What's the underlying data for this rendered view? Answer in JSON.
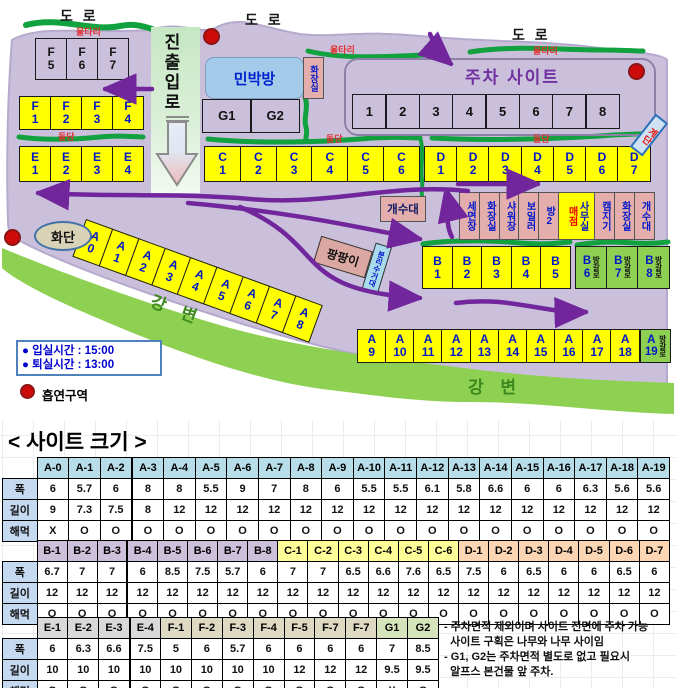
{
  "map": {
    "roads": [
      "도 로",
      "도 로",
      "도 로"
    ],
    "fence_labels": [
      "울타리",
      "울타리",
      "울타리"
    ],
    "wall_labels": [
      "돌담",
      "돌담",
      "돌담"
    ],
    "entrance": "진출입로",
    "minbak": "민박방",
    "toilet_vert": "화장실",
    "parking_title": "주차 사이트",
    "stairs": "계단",
    "sink": "개수대",
    "pang": "팡팡이",
    "recycle": "분리수거대",
    "flower": "화단",
    "bungalow_label": "방갈로",
    "river_labels": [
      "강 변",
      "강 변"
    ],
    "sites": {
      "f_top": [
        [
          "F",
          "5"
        ],
        [
          "F",
          "6"
        ],
        [
          "F",
          "7"
        ]
      ],
      "f": [
        [
          "F",
          "1"
        ],
        [
          "F",
          "2"
        ],
        [
          "F",
          "3"
        ],
        [
          "F",
          "4"
        ]
      ],
      "e": [
        [
          "E",
          "1"
        ],
        [
          "E",
          "2"
        ],
        [
          "E",
          "3"
        ],
        [
          "E",
          "4"
        ]
      ],
      "c": [
        [
          "C",
          "1"
        ],
        [
          "C",
          "2"
        ],
        [
          "C",
          "3"
        ],
        [
          "C",
          "4"
        ],
        [
          "C",
          "5"
        ],
        [
          "C",
          "6"
        ]
      ],
      "d": [
        [
          "D",
          "1"
        ],
        [
          "D",
          "2"
        ],
        [
          "D",
          "3"
        ],
        [
          "D",
          "4"
        ],
        [
          "D",
          "5"
        ],
        [
          "D",
          "6"
        ],
        [
          "D",
          "7"
        ]
      ],
      "parking": [
        [
          "1"
        ],
        [
          "2"
        ],
        [
          "3"
        ],
        [
          "4"
        ],
        [
          "5"
        ],
        [
          "6"
        ],
        [
          "7"
        ],
        [
          "8"
        ]
      ],
      "g": [
        [
          "G1"
        ],
        [
          "G2"
        ]
      ],
      "b": [
        [
          "B",
          "1"
        ],
        [
          "B",
          "2"
        ],
        [
          "B",
          "3"
        ],
        [
          "B",
          "4"
        ],
        [
          "B",
          "5"
        ]
      ],
      "b_bungalow": [
        [
          "B",
          "6"
        ],
        [
          "B",
          "7"
        ],
        [
          "B",
          "8"
        ]
      ],
      "a_diag": [
        [
          "A",
          "0"
        ],
        [
          "A",
          "1"
        ],
        [
          "A",
          "2"
        ],
        [
          "A",
          "3"
        ],
        [
          "A",
          "4"
        ],
        [
          "A",
          "5"
        ],
        [
          "A",
          "6"
        ],
        [
          "A",
          "7"
        ],
        [
          "A",
          "8"
        ]
      ],
      "a_row": [
        [
          "A",
          "9"
        ],
        [
          "A",
          "10"
        ],
        [
          "A",
          "11"
        ],
        [
          "A",
          "12"
        ],
        [
          "A",
          "13"
        ],
        [
          "A",
          "14"
        ],
        [
          "A",
          "15"
        ],
        [
          "A",
          "16"
        ],
        [
          "A",
          "17"
        ],
        [
          "A",
          "18"
        ]
      ],
      "a_bungalow": [
        [
          "A",
          "19"
        ]
      ]
    },
    "facilities": [
      {
        "t": "세면장"
      },
      {
        "t": "화장실"
      },
      {
        "t": "샤워장"
      },
      {
        "t": "보일러"
      },
      {
        "t": "방2"
      },
      {
        "t": "매점",
        "t2": "사무실"
      },
      {
        "t": "캠지기"
      },
      {
        "t": "화장실"
      },
      {
        "t": "개수대"
      }
    ],
    "legend": {
      "lines": [
        "● 입실시간 : 15:00",
        "● 퇴실시간 : 13:00"
      ],
      "smoking": "흡연구역"
    },
    "colors": {
      "site_yellow": "#ffff00",
      "bungalow_green": "#8ed051",
      "arrow_purple": "#71269c",
      "fence_green": "#11a13e",
      "map_bg": "#cbc0dc",
      "facility_pink": "#e3aeab",
      "minbak_blue": "#a5cbeb"
    }
  },
  "table_title": "< 사이트 크기 >",
  "row_labels": [
    "폭",
    "길이",
    "해먹"
  ],
  "header_colors": {
    "A": "#b7dee8",
    "B": "#ccc0da",
    "C": "#ffff99",
    "D": "#fcd5b4",
    "E": "#d9d9d9",
    "F": "#ddd9c3",
    "G": "#d6e4bc"
  },
  "tables": [
    {
      "columns": [
        "A-0",
        "A-1",
        "A-2",
        "A-3",
        "A-4",
        "A-5",
        "A-6",
        "A-7",
        "A-8",
        "A-9",
        "A-10",
        "A-11",
        "A-12",
        "A-13",
        "A-14",
        "A-15",
        "A-16",
        "A-17",
        "A-18",
        "A-19"
      ],
      "width": [
        "6",
        "5.7",
        "6",
        "8",
        "8",
        "5.5",
        "9",
        "7",
        "8",
        "6",
        "5.5",
        "5.5",
        "6.1",
        "5.8",
        "6.6",
        "6",
        "6",
        "6.3",
        "5.6",
        "5.6"
      ],
      "length": [
        "9",
        "7.3",
        "7.5",
        "8",
        "12",
        "12",
        "12",
        "12",
        "12",
        "12",
        "12",
        "12",
        "12",
        "12",
        "12",
        "12",
        "12",
        "12",
        "12",
        "12"
      ],
      "hammock": [
        "X",
        "O",
        "O",
        "O",
        "O",
        "O",
        "O",
        "O",
        "O",
        "O",
        "O",
        "O",
        "O",
        "O",
        "O",
        "O",
        "O",
        "O",
        "O",
        "O"
      ]
    },
    {
      "columns": [
        "B-1",
        "B-2",
        "B-3",
        "B-4",
        "B-5",
        "B-6",
        "B-7",
        "B-8",
        "C-1",
        "C-2",
        "C-3",
        "C-4",
        "C-5",
        "C-6",
        "D-1",
        "D-2",
        "D-3",
        "D-4",
        "D-5",
        "D-6",
        "D-7"
      ],
      "width": [
        "6.7",
        "7",
        "7",
        "6",
        "8.5",
        "7.5",
        "5.7",
        "6",
        "7",
        "7",
        "6.5",
        "6.6",
        "7.6",
        "6.5",
        "7.5",
        "6",
        "6.5",
        "6",
        "6",
        "6.5",
        "6"
      ],
      "length": [
        "12",
        "12",
        "12",
        "12",
        "12",
        "12",
        "12",
        "12",
        "12",
        "12",
        "12",
        "12",
        "12",
        "12",
        "12",
        "12",
        "12",
        "12",
        "12",
        "12",
        "12"
      ],
      "hammock": [
        "O",
        "O",
        "O",
        "O",
        "O",
        "O",
        "O",
        "O",
        "O",
        "O",
        "O",
        "O",
        "O",
        "O",
        "O",
        "O",
        "O",
        "O",
        "O",
        "O",
        "O"
      ]
    },
    {
      "columns": [
        "E-1",
        "E-2",
        "E-3",
        "E-4",
        "F-1",
        "F-2",
        "F-3",
        "F-4",
        "F-5",
        "F-7",
        "F-7",
        "G1",
        "G2"
      ],
      "width": [
        "6",
        "6.3",
        "6.6",
        "7.5",
        "5",
        "6",
        "5.7",
        "6",
        "6",
        "6",
        "6",
        "7",
        "8.5"
      ],
      "length": [
        "10",
        "10",
        "10",
        "10",
        "10",
        "10",
        "10",
        "10",
        "12",
        "12",
        "12",
        "9.5",
        "9.5"
      ],
      "hammock": [
        "O",
        "O",
        "O",
        "O",
        "O",
        "O",
        "O",
        "O",
        "O",
        "O",
        "O",
        "X",
        "O"
      ]
    }
  ],
  "notes": [
    "- 주차면적 제외이며 사이트 전면에 주차 가능",
    "  사이트 구획은 나무와 나무 사이임",
    "- G1, G2는 주차면적 별도로 없고 필요시",
    "  알프스 본건물 앞 주차."
  ]
}
